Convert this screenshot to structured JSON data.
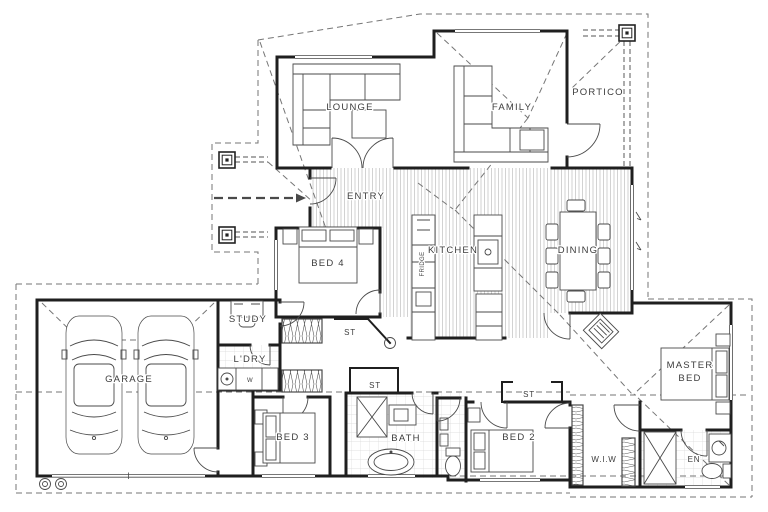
{
  "title": "House floor plan drawing",
  "colors": {
    "background": "#ffffff",
    "wall": "#1f1f1f",
    "furniture_line": "#4a4a4a",
    "roof_dash": "#767676",
    "floor_hatch": "#c7c7c7",
    "tile": "#d9d9d9",
    "label_text": "#3c3c3c"
  },
  "labels": {
    "lounge": "LOUNGE",
    "family": "FAMILY",
    "portico": "PORTICO",
    "entry": "ENTRY",
    "kitchen": "KITCHEN",
    "dining": "DINING",
    "bed4": "BED 4",
    "study": "STUDY",
    "laundry": "L'DRY",
    "garage": "GARAGE",
    "bed3": "BED 3",
    "bath": "BATH",
    "bed2": "BED 2",
    "wiw": "W.I.W",
    "master_line1": "MASTER",
    "master_line2": "BED",
    "ensuite": "EN",
    "st_hall": "ST",
    "st_bath": "ST",
    "st_bed2": "ST",
    "washer": "W",
    "fridge": "FRIDGE"
  }
}
